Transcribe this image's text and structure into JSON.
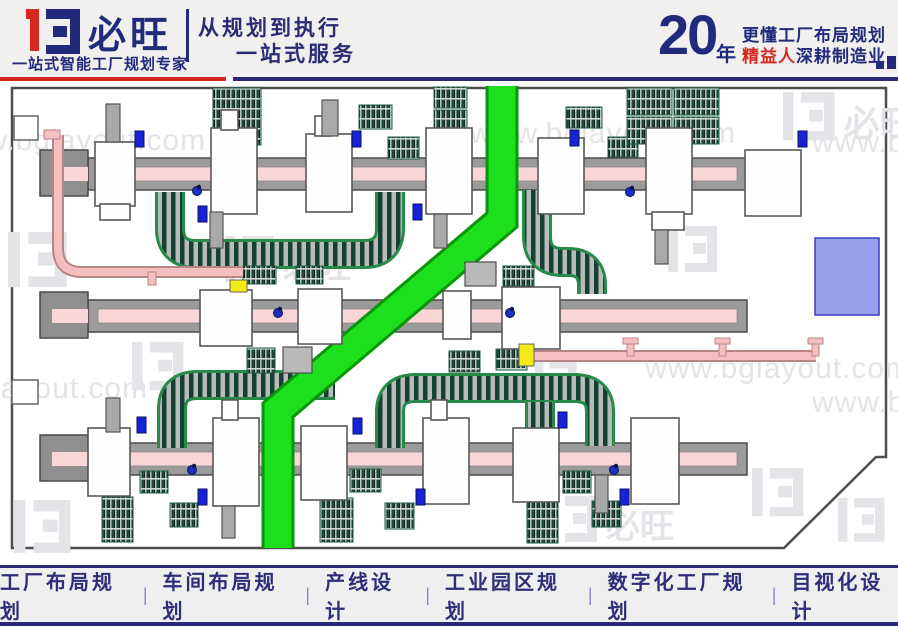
{
  "header": {
    "brand": "必旺",
    "tagline": "一站式智能工厂规划专家",
    "slogan1": "从规划到执行",
    "slogan2": "一站式服务",
    "years": "20",
    "years_unit": "年",
    "right1": "更懂工厂布局规划",
    "right2_red": "精益人",
    "right2_rest": "深耕制造业"
  },
  "watermarks": {
    "url": "www.bglayout.com",
    "brand": "必旺"
  },
  "footer": {
    "items": [
      "工厂布局规划",
      "车间布局规划",
      "产线设计",
      "工业园区规划",
      "数字化工厂规划",
      "目视化设计"
    ],
    "separator": "|"
  },
  "colors": {
    "navy": "#212a7c",
    "red": "#d5281e",
    "wall": "#4d4d4d",
    "rail": "#9b9b9b",
    "pink": "#f8d6d7",
    "road_core": "#1be01b",
    "road_edge": "#0a960a",
    "pipe": "#f5bfc0",
    "pipe_edge": "#b98486",
    "purple": "#98a0ec",
    "yellow": "#f4ea16",
    "blue_marker": "#1723d6",
    "watermark": "#e4e4e8"
  },
  "diagram": {
    "boundary": [
      [
        12,
        88
      ],
      [
        886,
        88
      ],
      [
        886,
        457
      ],
      [
        876,
        457
      ],
      [
        784,
        548
      ],
      [
        12,
        548
      ]
    ],
    "wall_boxes": [
      [
        14,
        116,
        24,
        24
      ],
      [
        12,
        380,
        26,
        24
      ]
    ],
    "road": {
      "path": "M 502,86 L 502,220 L 278,410 L 278,548",
      "core_w": 27,
      "edge_w": 33
    },
    "rails": [
      {
        "x": 88,
        "x2": 747,
        "y": 158,
        "h": 32,
        "head": [
          40,
          150,
          48,
          46
        ]
      },
      {
        "x": 88,
        "x2": 747,
        "y": 300,
        "h": 32,
        "head": [
          40,
          292,
          48,
          46
        ]
      },
      {
        "x": 88,
        "x2": 747,
        "y": 443,
        "h": 32,
        "head": [
          40,
          435,
          48,
          46
        ]
      }
    ],
    "machines": [
      [
        95,
        142,
        40,
        64
      ],
      [
        100,
        204,
        30,
        16
      ],
      [
        211,
        128,
        46,
        86
      ],
      [
        221,
        110,
        17,
        20
      ],
      [
        306,
        134,
        46,
        78
      ],
      [
        315,
        116,
        16,
        20
      ],
      [
        426,
        128,
        46,
        86
      ],
      [
        538,
        138,
        46,
        76
      ],
      [
        646,
        128,
        46,
        86
      ],
      [
        652,
        212,
        32,
        18
      ],
      [
        745,
        150,
        56,
        66
      ],
      [
        200,
        290,
        52,
        56
      ],
      [
        298,
        289,
        44,
        55
      ],
      [
        443,
        291,
        28,
        48
      ],
      [
        502,
        287,
        58,
        62
      ],
      [
        88,
        428,
        42,
        68
      ],
      [
        213,
        418,
        46,
        88
      ],
      [
        222,
        400,
        16,
        20
      ],
      [
        301,
        426,
        46,
        74
      ],
      [
        423,
        418,
        46,
        86
      ],
      [
        431,
        400,
        16,
        20
      ],
      [
        513,
        428,
        46,
        74
      ],
      [
        631,
        418,
        48,
        86
      ]
    ],
    "stubs": [
      [
        106,
        104,
        14,
        38
      ],
      [
        322,
        100,
        16,
        36
      ],
      [
        210,
        212,
        13,
        36
      ],
      [
        434,
        214,
        13,
        34
      ],
      [
        655,
        230,
        13,
        34
      ],
      [
        106,
        398,
        14,
        34
      ],
      [
        222,
        506,
        13,
        32
      ],
      [
        595,
        475,
        13,
        38
      ]
    ],
    "racks": [
      [
        213,
        88,
        48,
        57
      ],
      [
        434,
        87,
        33,
        21
      ],
      [
        434,
        110,
        33,
        22
      ],
      [
        359,
        105,
        33,
        24
      ],
      [
        388,
        137,
        31,
        22
      ],
      [
        566,
        107,
        36,
        21
      ],
      [
        608,
        137,
        30,
        20
      ],
      [
        627,
        88,
        45,
        27
      ],
      [
        627,
        117,
        45,
        27
      ],
      [
        674,
        88,
        45,
        27
      ],
      [
        674,
        117,
        45,
        27
      ],
      [
        243,
        266,
        33,
        18
      ],
      [
        296,
        266,
        27,
        18
      ],
      [
        503,
        266,
        31,
        20
      ],
      [
        247,
        348,
        28,
        25
      ],
      [
        449,
        351,
        31,
        21
      ],
      [
        496,
        349,
        31,
        21
      ],
      [
        140,
        471,
        28,
        22
      ],
      [
        350,
        469,
        31,
        23
      ],
      [
        563,
        471,
        28,
        22
      ],
      [
        102,
        497,
        31,
        45
      ],
      [
        170,
        503,
        28,
        24
      ],
      [
        320,
        498,
        33,
        44
      ],
      [
        385,
        503,
        29,
        26
      ],
      [
        527,
        495,
        31,
        48
      ],
      [
        592,
        501,
        29,
        26
      ]
    ],
    "belts": [
      "M 170,192 V 228 Q 170,254 196,254 H 364 Q 390,254 390,228 V 192",
      "M 537,190 V 236 Q 537,262 563,262 H 568 Q 592,262 592,286 V 294",
      "M 172,448 V 409 Q 172,385 198,385 H 335",
      "M 390,448 V 412 Q 390,388 416,388 H 574 Q 600,388 600,412 V 446",
      "M 540,402 V 446"
    ],
    "pipes": [
      {
        "d": "M 58,135 V 248 Q 58,272 82,272 H 243",
        "supports": [
          [
            148,
            272,
            8,
            13
          ]
        ],
        "caps": [
          [
            44,
            130,
            16,
            9
          ]
        ]
      },
      {
        "d": "M 534,356 H 816",
        "supports": [
          [
            627,
            342,
            7,
            14
          ],
          [
            719,
            342,
            7,
            14
          ],
          [
            812,
            342,
            7,
            14
          ]
        ],
        "caps": [
          [
            623,
            338,
            15,
            6
          ],
          [
            715,
            338,
            15,
            6
          ],
          [
            808,
            338,
            15,
            6
          ]
        ]
      }
    ],
    "zones": {
      "purple": [
        815,
        238,
        64,
        77
      ],
      "gray": [
        [
          465,
          262,
          31,
          24
        ],
        [
          283,
          347,
          29,
          26
        ]
      ]
    },
    "markers": {
      "blue": [
        [
          135,
          131
        ],
        [
          198,
          206
        ],
        [
          352,
          131
        ],
        [
          413,
          204
        ],
        [
          570,
          130
        ],
        [
          798,
          131
        ],
        [
          137,
          417
        ],
        [
          198,
          489
        ],
        [
          353,
          418
        ],
        [
          416,
          489
        ],
        [
          558,
          412
        ],
        [
          620,
          489
        ]
      ],
      "yellow": [
        [
          230,
          280,
          17,
          12
        ],
        [
          519,
          344,
          15,
          22
        ]
      ],
      "workers": [
        [
          197,
          191
        ],
        [
          630,
          192
        ],
        [
          278,
          313
        ],
        [
          510,
          313
        ],
        [
          192,
          470
        ],
        [
          614,
          470
        ]
      ]
    },
    "wm_texts": [
      [
        -118,
        398
      ],
      [
        645,
        378
      ],
      [
        812,
        412
      ],
      [
        -60,
        150
      ],
      [
        470,
        143
      ],
      [
        812,
        152
      ]
    ],
    "wm_logos": [
      [
        8,
        232,
        1.2,
        0
      ],
      [
        225,
        236,
        1.0,
        1
      ],
      [
        668,
        226,
        1.0,
        0
      ],
      [
        783,
        92,
        1.05,
        1
      ],
      [
        14,
        500,
        1.15,
        0
      ],
      [
        548,
        496,
        1.0,
        1
      ],
      [
        752,
        468,
        1.05,
        0
      ],
      [
        838,
        498,
        0.95,
        0
      ],
      [
        535,
        360,
        0.85,
        0
      ],
      [
        132,
        342,
        1.05,
        0
      ]
    ]
  }
}
